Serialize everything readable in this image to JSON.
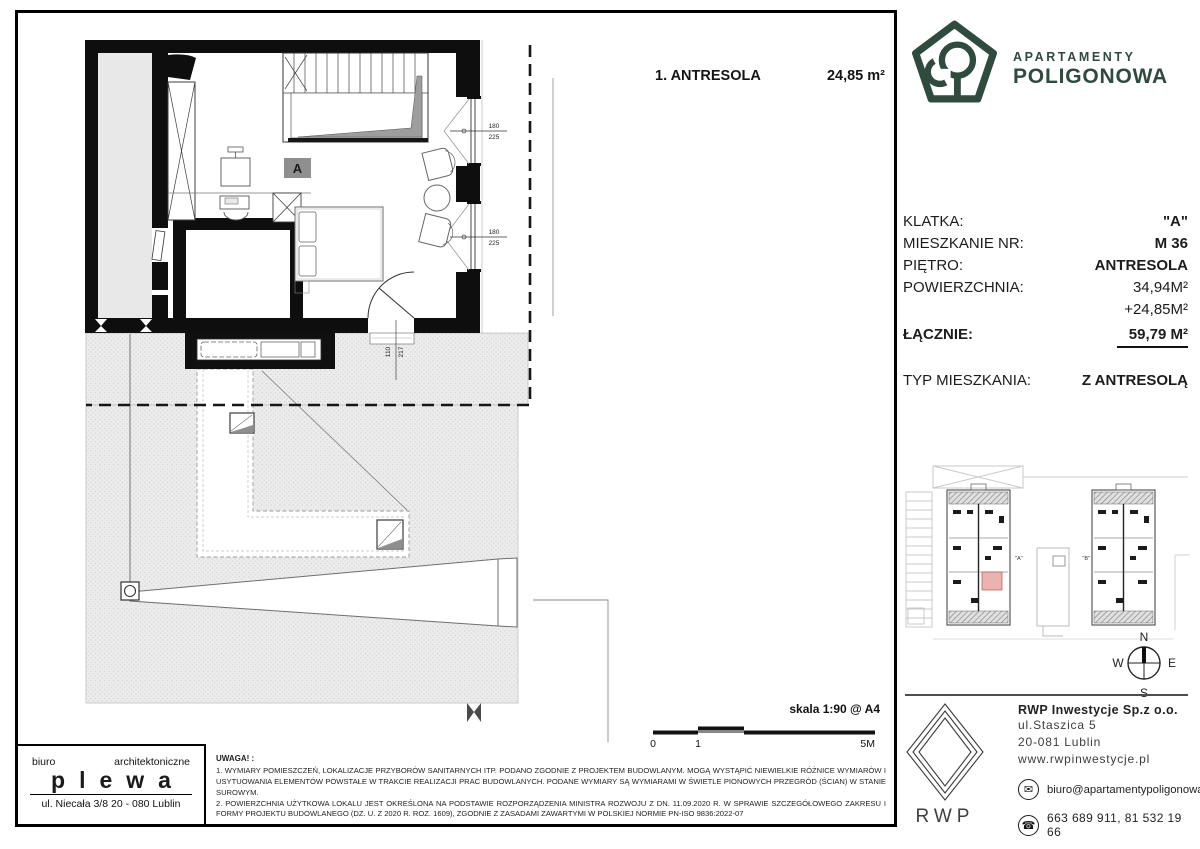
{
  "header": {
    "plan_title": "1. ANTRESOLA",
    "plan_area": "24,85 m²"
  },
  "brand": {
    "name_line1": "APARTAMENTY",
    "name_line2": "POLIGONOWA",
    "color": "#2e4b3e"
  },
  "unit_info": {
    "rows": [
      {
        "label": "KLATKA:",
        "value": "\"A\""
      },
      {
        "label": "MIESZKANIE NR:",
        "value": "M  36"
      },
      {
        "label": "PIĘTRO:",
        "value": "ANTRESOLA"
      },
      {
        "label": "POWIERZCHNIA:",
        "value": "34,94M²"
      },
      {
        "label": "",
        "value": "+24,85M²"
      }
    ],
    "total_label": "ŁĄCZNIE:",
    "total_value": "59,79 M²",
    "type_label": "TYP MIESZKANIA:",
    "type_value": "Z ANTRESOLĄ"
  },
  "plan": {
    "room_label": "A",
    "window_width": "180",
    "window_height": "225",
    "door_width": "110",
    "door_height": "217"
  },
  "scalebar": {
    "label": "skala 1:90 @ A4",
    "tick0": "0",
    "tick1": "1",
    "tick_end": "5M"
  },
  "architect": {
    "prefix": "biuro",
    "prefix2": "architektoniczne",
    "name": "plewa",
    "address": "ul. Niecała 3/8  20 - 080 Lublin"
  },
  "notes": {
    "title": "UWAGA! :",
    "note1": "1. WYMIARY POMIESZCZEŃ, LOKALIZACJE PRZYBORÓW SANITARNYCH ITP. PODANO ZGODNIE Z PROJEKTEM BUDOWLANYM. MOGĄ WYSTĄPIĆ NIEWIELKIE RÓŻNICE WYMIARÓW I USYTUOWANIA ELEMENTÓW POWSTAŁE W TRAKCIE REALIZACJI PRAC BUDOWLANYCH. PODANE WYMIARY SĄ WYMIARAMI W ŚWIETLE PIONOWYCH PRZEGRÓD (ŚCIAN) W STANIE SUROWYM.",
    "note2": "2. POWIERZCHNIA UŻYTKOWA LOKALU JEST OKREŚLONA NA PODSTAWIE ROZPORZĄDZENIA MINISTRA ROZWOJU Z DN. 11.09.2020 R. W SPRAWIE SZCZEGÓŁOWEGO ZAKRESU I FORMY PROJEKTU BUDOWLANEGO (DZ. U. Z 2020 R. ROZ. 1609), ZGODNIE Z ZASADAMI ZAWARTYMI W POLSKIEJ NORMIE PN-ISO 9836:2022-07",
    "note_title_suffix": ""
  },
  "sitemap": {
    "label_a": "\"A\"",
    "label_b": "\"B\"",
    "highlight_color": "#e9b4af"
  },
  "compass": {
    "n": "N",
    "e": "E",
    "s": "S",
    "w": "W"
  },
  "developer": {
    "logo_text": "RWP",
    "company": "RWP Inwestycje Sp.z o.o.",
    "street": "ul.Staszica 5",
    "city": "20-081 Lublin",
    "website": "www.rwpinwestycje.pl",
    "email": "biuro@apartamentypoligonowa.pl",
    "phones": "663 689 911,  81 532 19 66"
  }
}
